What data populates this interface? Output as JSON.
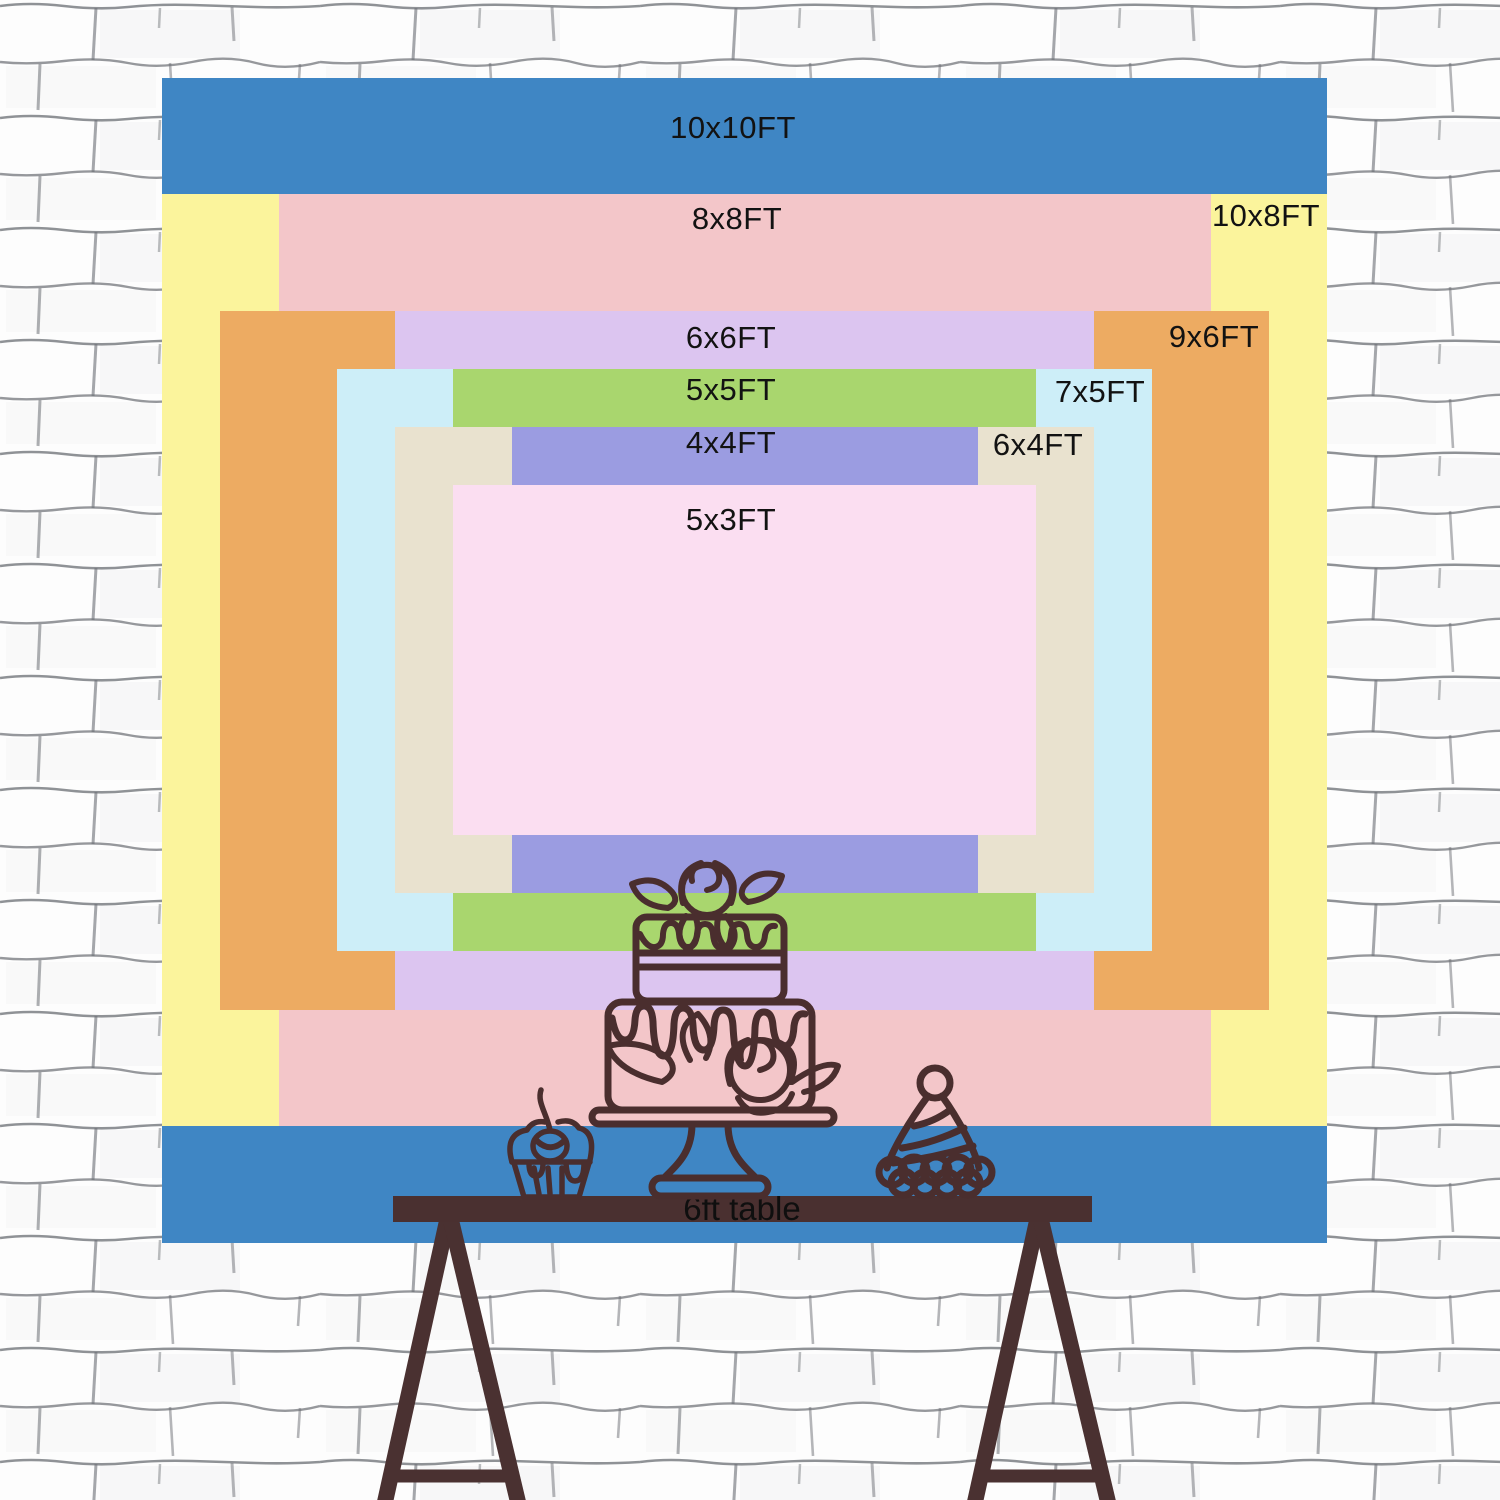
{
  "backdrop_chart": {
    "description": "nested backdrop size comparison",
    "px_per_ft": 116.5,
    "center": {
      "x": 744.5,
      "y": 660
    },
    "sizes": [
      {
        "label": "10x10FT",
        "w_ft": 10,
        "h_ft": 10,
        "color": "#3f86c4",
        "label_x": 733,
        "label_y": 128
      },
      {
        "label": "10x8FT",
        "w_ft": 10,
        "h_ft": 8,
        "color": "#fbf49c",
        "label_x": 1266,
        "label_y": 216
      },
      {
        "label": "8x8FT",
        "w_ft": 8,
        "h_ft": 8,
        "color": "#f3c6c9",
        "label_x": 737,
        "label_y": 219
      },
      {
        "label": "9x6FT",
        "w_ft": 9,
        "h_ft": 6,
        "color": "#edab62",
        "label_x": 1214,
        "label_y": 337
      },
      {
        "label": "6x6FT",
        "w_ft": 6,
        "h_ft": 6,
        "color": "#dcc5f0",
        "label_x": 731,
        "label_y": 338
      },
      {
        "label": "7x5FT",
        "w_ft": 7,
        "h_ft": 5,
        "color": "#cdeef8",
        "label_x": 1100,
        "label_y": 392
      },
      {
        "label": "5x5FT",
        "w_ft": 5,
        "h_ft": 5,
        "color": "#a9d66e",
        "label_x": 731,
        "label_y": 390
      },
      {
        "label": "6x4FT",
        "w_ft": 6,
        "h_ft": 4,
        "color": "#e9e2cf",
        "label_x": 1038,
        "label_y": 445
      },
      {
        "label": "4x4FT",
        "w_ft": 4,
        "h_ft": 4,
        "color": "#9b9ce1",
        "label_x": 731,
        "label_y": 443
      },
      {
        "label": "5x3FT",
        "w_ft": 5,
        "h_ft": 3,
        "color": "#fbdef1",
        "label_x": 731,
        "label_y": 520
      }
    ]
  },
  "table": {
    "label": "6ft table",
    "bar_color": "#4a3030",
    "text_color": "#0f0f0f"
  },
  "decorations": {
    "items": [
      "cupcake-with-cherry",
      "two-tier-drip-cake-on-stand",
      "party-hat"
    ],
    "line_color": "#4a2e2e"
  },
  "wall": {
    "base_color": "#fdfdfd",
    "mortar_line_color": "#6b6e74"
  }
}
